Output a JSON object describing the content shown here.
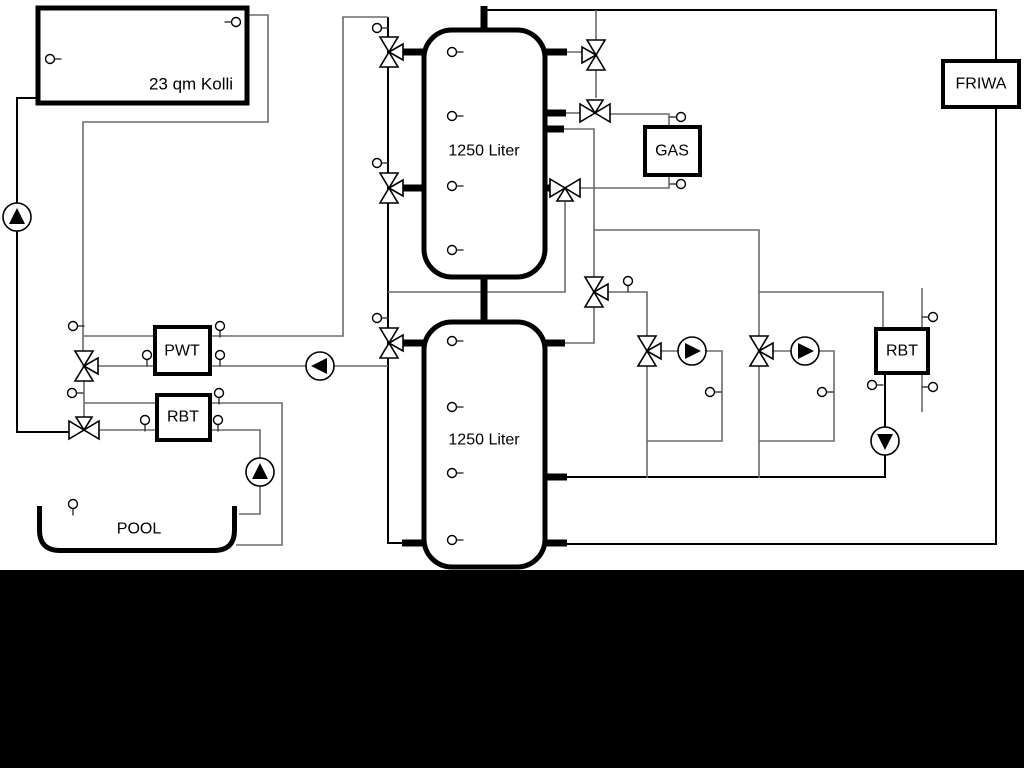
{
  "diagram": {
    "labels": {
      "collector": "23 qm Kolli",
      "tank_top": "1250 Liter",
      "tank_bottom": "1250 Liter",
      "pwt": "PWT",
      "rbt_left": "RBT",
      "gas": "GAS",
      "friwa": "FRIWA",
      "rbt_right": "RBT",
      "pool": "POOL"
    },
    "colors": {
      "pipe": "#6b6b6b",
      "dark_pipe": "#000000",
      "component_stroke": "#000000",
      "background": "#ffffff",
      "bottom_band": "#000000"
    }
  }
}
